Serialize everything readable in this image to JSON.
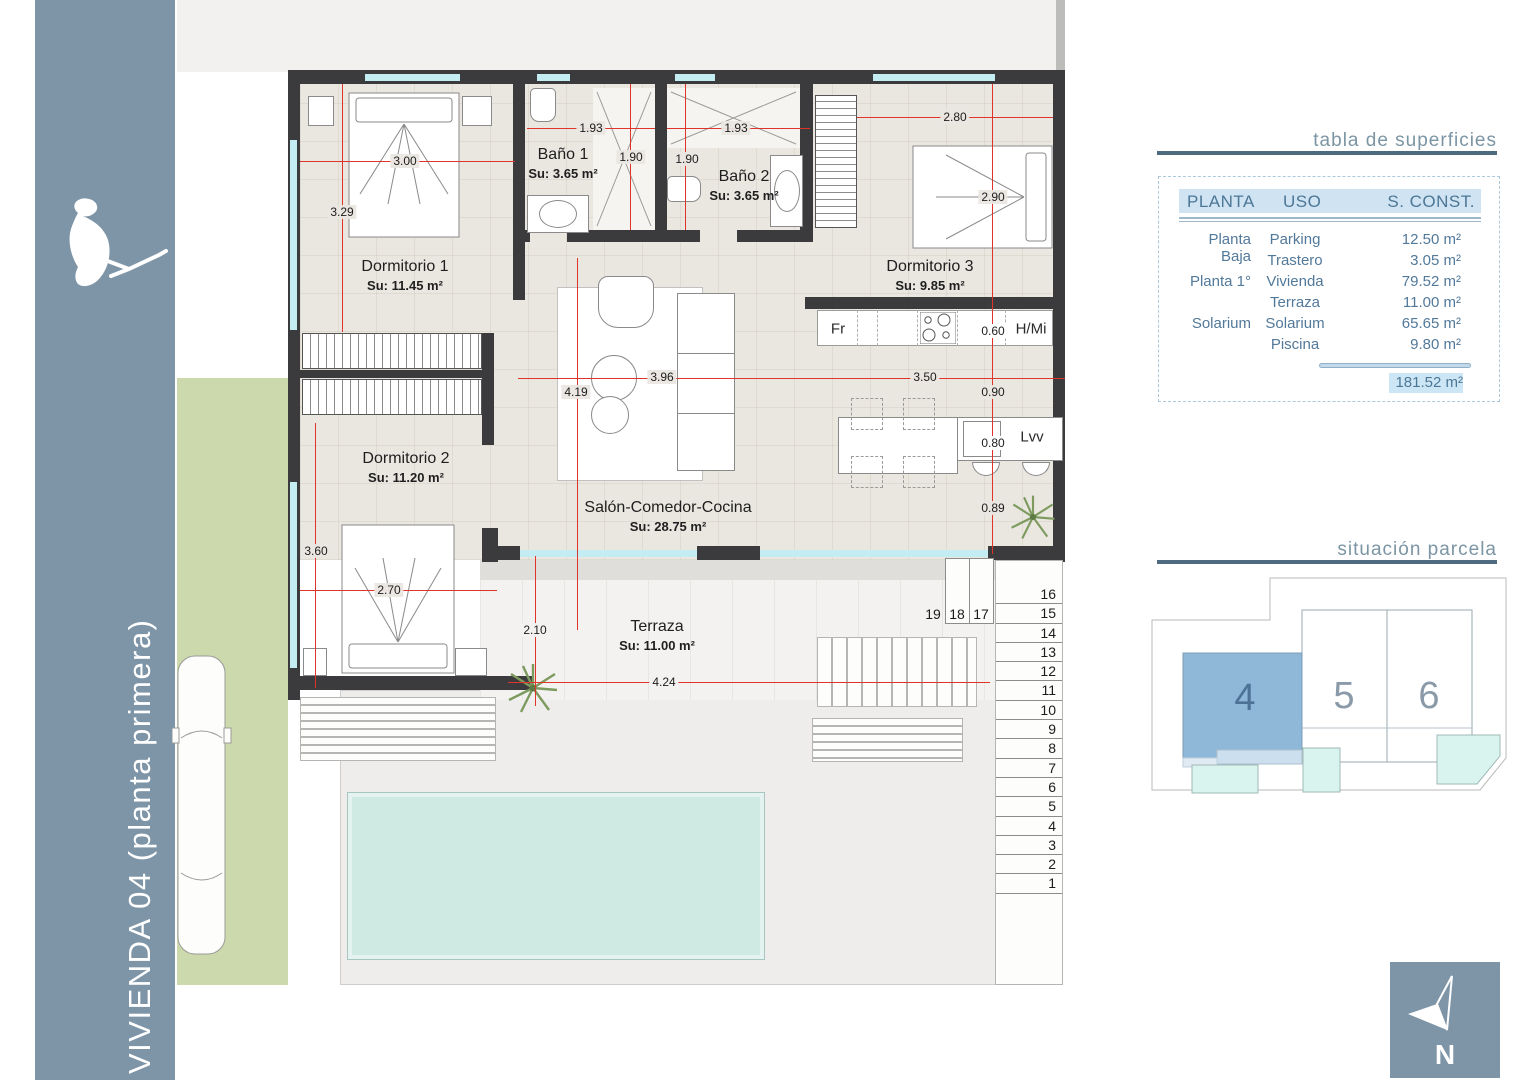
{
  "sidebar": {
    "title": "VIVIENDA 04 (planta primera)"
  },
  "rooms": {
    "dorm1": {
      "name": "Dormitorio 1",
      "area": "Su: 11.45 m²"
    },
    "bano1": {
      "name": "Baño 1",
      "area": "Su: 3.65 m²"
    },
    "bano2": {
      "name": "Baño 2",
      "area": "Su: 3.65 m²"
    },
    "dorm3": {
      "name": "Dormitorio 3",
      "area": "Su: 9.85 m²"
    },
    "dorm2": {
      "name": "Dormitorio 2",
      "area": "Su: 11.20 m²"
    },
    "salon": {
      "name": "Salón-Comedor-Cocina",
      "area": "Su: 28.75 m²"
    },
    "terraza": {
      "name": "Terraza",
      "area": "Su: 11.00 m²"
    }
  },
  "kitchen": {
    "fr": "Fr",
    "hmi": "H/Mi",
    "lvv": "Lvv"
  },
  "dims": {
    "dorm1_w": "3.00",
    "dorm1_h": "3.29",
    "bano1_w": "1.93",
    "bano1_h": "1.90",
    "bano2_w": "1.93",
    "bano2_h": "1.90",
    "dorm3_w": "2.80",
    "dorm3_h": "2.90",
    "kitchen_gap": "0.60",
    "kitchen_w": "3.50",
    "pass_w": "0.90",
    "salon_h": "4.19",
    "salon_w": "3.96",
    "island_w": "0.80",
    "island_gap": "0.89",
    "dorm2_h": "3.60",
    "dorm2_w": "2.70",
    "terraza_h": "2.10",
    "terraza_w": "4.24"
  },
  "stairs": {
    "top": [
      "19",
      "18",
      "17"
    ],
    "steps": [
      "16",
      "15",
      "14",
      "13",
      "12",
      "11",
      "10",
      "9",
      "8",
      "7",
      "6",
      "5",
      "4",
      "3",
      "2",
      "1"
    ]
  },
  "panel": {
    "surfaces_title": "tabla de superficies",
    "table": {
      "headers": [
        "PLANTA",
        "USO",
        "S. CONST."
      ],
      "rows": [
        [
          "Planta Baja",
          "Parking",
          "12.50 m²"
        ],
        [
          "",
          "Trastero",
          "3.05 m²"
        ],
        [
          "Planta 1°",
          "Vivienda",
          "79.52 m²"
        ],
        [
          "",
          "Terraza",
          "11.00 m²"
        ],
        [
          "Solarium",
          "Solarium",
          "65.65 m²"
        ],
        [
          "",
          "Piscina",
          "9.80 m²"
        ]
      ],
      "total": "181.52 m²"
    },
    "parcela_title": "situación parcela",
    "plots": {
      "p4": "4",
      "p5": "5",
      "p6": "6"
    },
    "north_label": "N"
  },
  "colors": {
    "sidebar": "#7e95a8",
    "wall": "#3b3b3d",
    "dimension_red": "#e0342b",
    "window_glass": "#c4edf3",
    "floor_beige": "#eae6e0",
    "grass": "#ccd9ad",
    "pool": "#cfeae3",
    "table_header_bg": "#cfe3f2",
    "panel_blue_text": "#4c7796",
    "plot_highlight": "#8fb8d8",
    "plot_terrace": "#ccdfee",
    "small_pool": "#d9f4ee"
  }
}
